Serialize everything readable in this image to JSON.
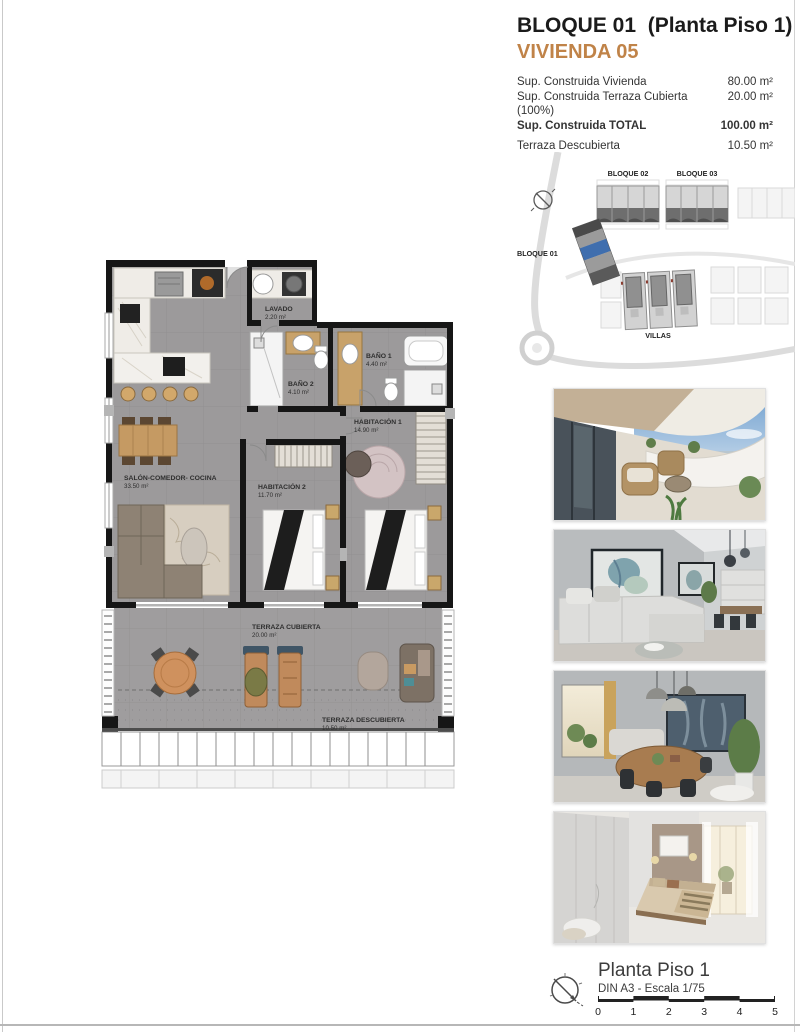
{
  "header": {
    "title": "BLOQUE 01  (Planta Piso 1)",
    "subtitle": "VIVIENDA 05",
    "rows": [
      {
        "label": "Sup. Construida Vivienda",
        "value": "80.00 m²"
      },
      {
        "label": "Sup. Construida Terraza Cubierta (100%)",
        "value": "20.00 m²"
      },
      {
        "label": "Sup. Construida TOTAL",
        "value": "100.00 m²"
      },
      {
        "label": "Terraza Descubierta",
        "value": "10.50 m²"
      }
    ]
  },
  "site_plan": {
    "bloque01": "BLOQUE 01",
    "bloque02": "BLOQUE 02",
    "bloque03": "BLOQUE 03",
    "villas": "VILLAS",
    "highlight_color": "#3f6eae"
  },
  "floor_plan": {
    "rooms": [
      {
        "name": "LAVADO",
        "area": "2.20 m²"
      },
      {
        "name": "BAÑO 2",
        "area": "4.10 m²"
      },
      {
        "name": "BAÑO 1",
        "area": "4.40 m²"
      },
      {
        "name": "HABITACIÓN 1",
        "area": "14.90 m²"
      },
      {
        "name": "HABITACIÓN 2",
        "area": "11.70 m²"
      },
      {
        "name": "SALÓN-COMEDOR- COCINA",
        "area": "33.50 m²"
      },
      {
        "name": "TERRAZA CUBIERTA",
        "area": "20.00 m²"
      },
      {
        "name": "TERRAZA DESCUBIERTA",
        "area": "10.50 m²"
      }
    ]
  },
  "footer": {
    "title": "Planta Piso 1",
    "scale_note": "DIN A3 - Escala 1/75",
    "scale_ticks": [
      "0",
      "1",
      "2",
      "3",
      "4",
      "5"
    ]
  },
  "colors": {
    "accent": "#c08348",
    "highlight_blue": "#3f6eae"
  }
}
